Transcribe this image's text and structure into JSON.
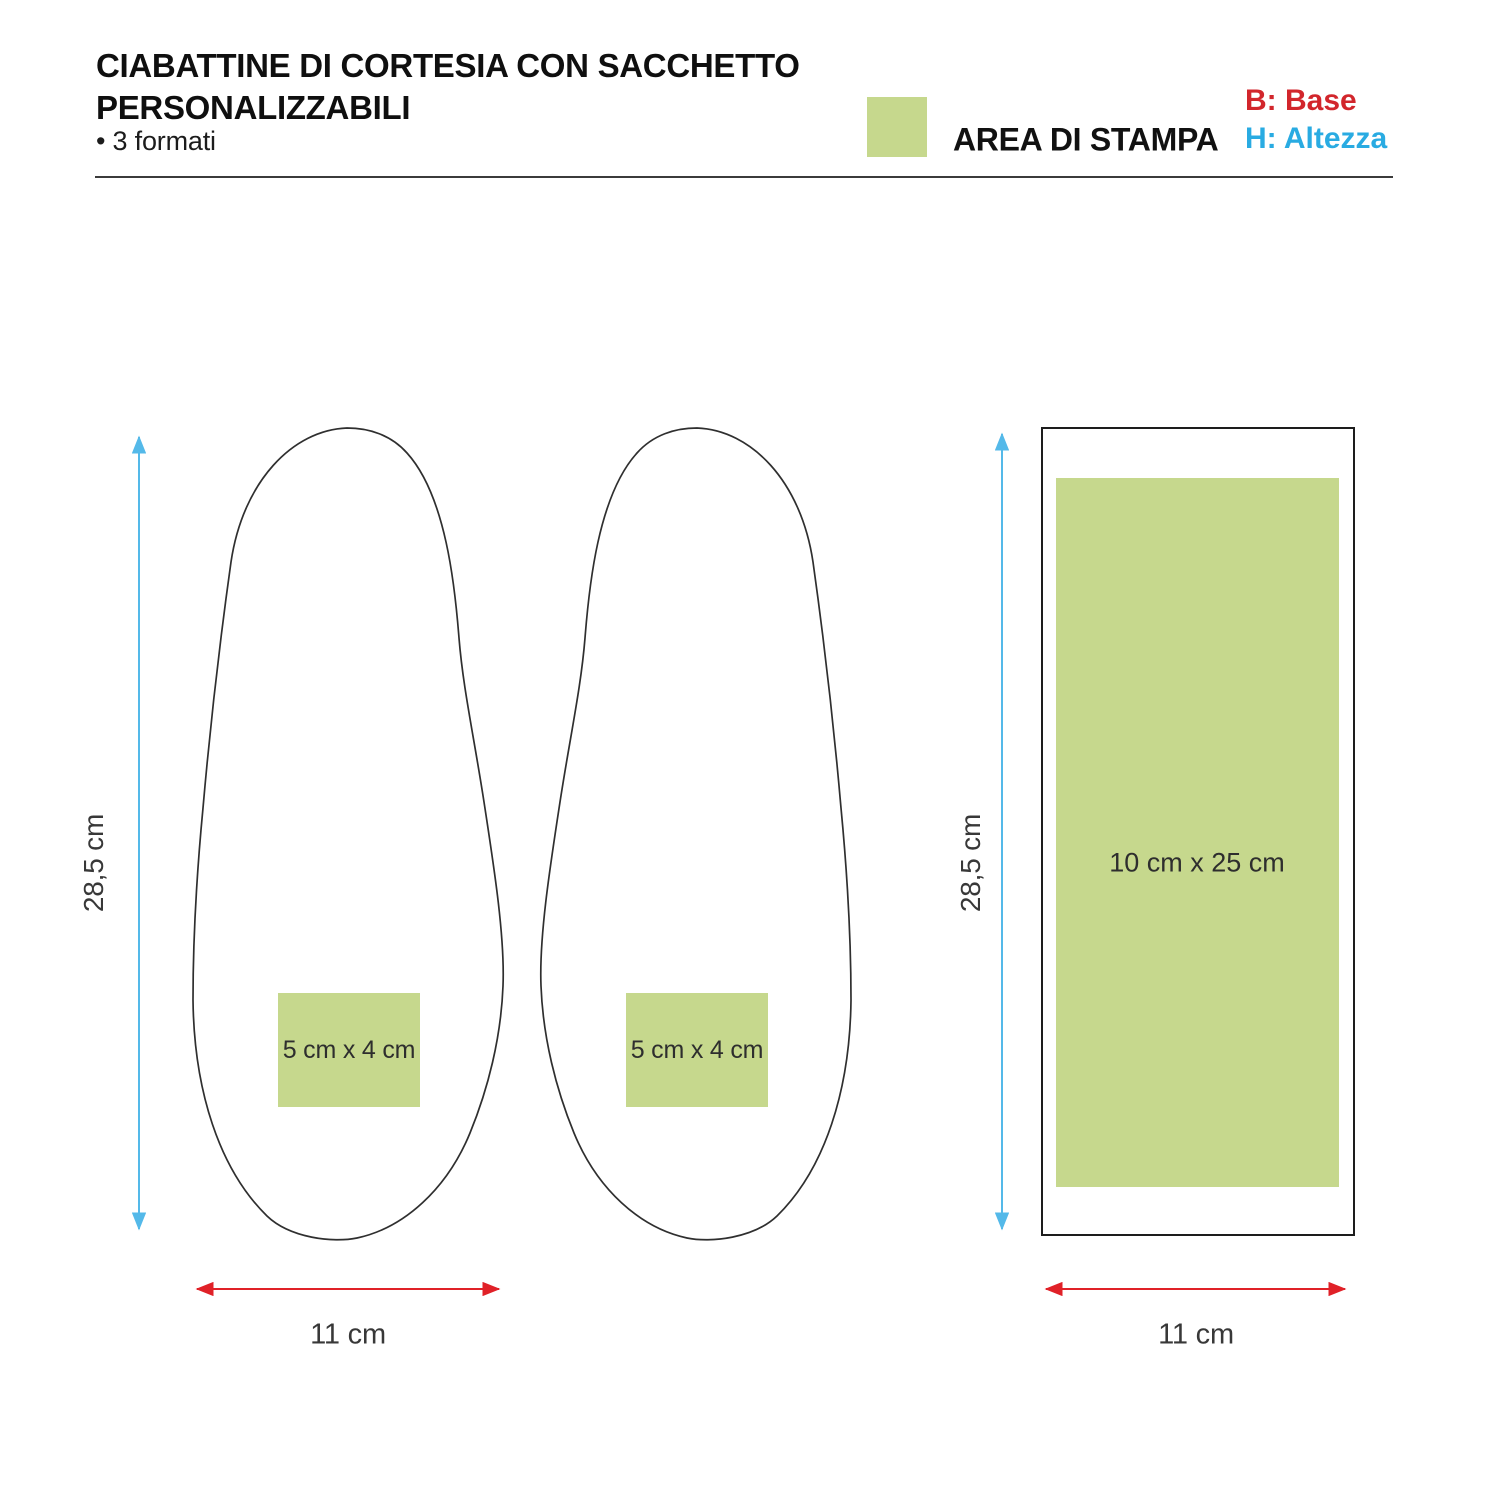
{
  "header": {
    "title_line1": "CIABATTINE DI CORTESIA CON SACCHETTO",
    "title_line2": "PERSONALIZZABILI",
    "subtitle": "• 3 formati"
  },
  "legend": {
    "area_label": "AREA DI STAMPA",
    "base_label": "B: Base",
    "height_label": "H: Altezza"
  },
  "slippers": {
    "left": {
      "print_label": "5 cm x 4 cm"
    },
    "right": {
      "print_label": "5 cm x 4 cm"
    },
    "height_label": "28,5 cm",
    "width_label": "11 cm"
  },
  "bag": {
    "print_label": "10 cm x 25 cm",
    "height_label": "28,5 cm",
    "width_label": "11 cm"
  },
  "colors": {
    "print_area_green": "#c6d88d",
    "dimension_red": "#e02128",
    "dimension_blue": "#54b9e9",
    "legend_red": "#d2262c",
    "legend_blue": "#29abe2",
    "outline_dark": "#2f2f2f"
  }
}
